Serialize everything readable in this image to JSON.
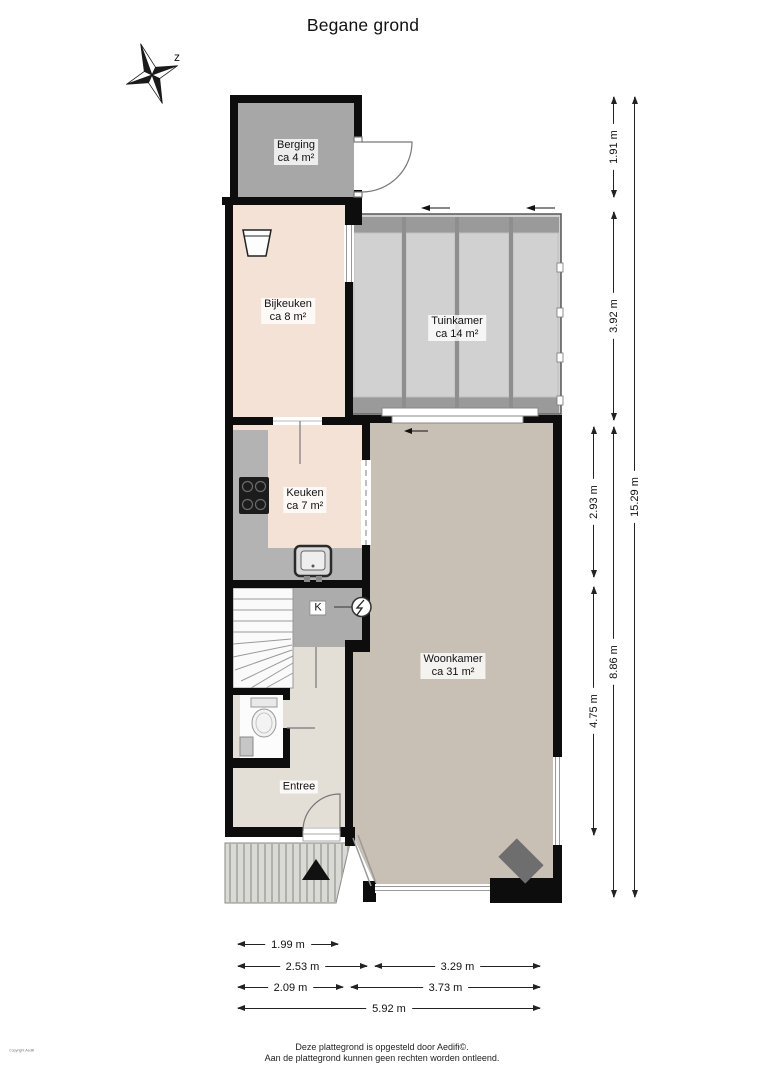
{
  "title": "Begane grond",
  "compass": {
    "label": "z"
  },
  "rooms": {
    "berging": {
      "name": "Berging",
      "area": "ca 4 m²"
    },
    "bijkeuken": {
      "name": "Bijkeuken",
      "area": "ca 8 m²"
    },
    "tuinkamer": {
      "name": "Tuinkamer",
      "area": "ca 14 m²"
    },
    "keuken": {
      "name": "Keuken",
      "area": "ca 7 m²"
    },
    "woonkamer": {
      "name": "Woonkamer",
      "area": "ca 31 m²"
    },
    "entree": {
      "name": "Entree"
    },
    "kast": {
      "name": "K"
    }
  },
  "dimensions": {
    "right": [
      "1.91 m",
      "3.92 m",
      "2.93 m",
      "4.75 m",
      "8.86 m",
      "15.29 m"
    ],
    "bottom": [
      "1.99 m",
      "2.53 m",
      "3.29 m",
      "2.09 m",
      "3.73 m",
      "5.92 m"
    ]
  },
  "footer": {
    "line1": "Deze plattegrond is opgesteld door Aedifi©.",
    "line2": "Aan de plattegrond kunnen geen rechten worden ontleend."
  },
  "copyright_vertical": "Copyright Aedifi",
  "colors": {
    "wall": "#0d0d0d",
    "berging_floor": "#a7a7a7",
    "utility_floor": "#f5e2d6",
    "tuinkamer_floor": "#d1d1d1",
    "tuinkamer_band": "#9a9a9a",
    "woonkamer_floor": "#c9c0b5",
    "entree_floor": "#e3ded6",
    "counter": "#b3b3b3",
    "closet": "#acacac",
    "porch": "#d9d9d5",
    "porch_stripe": "#b0b0ab",
    "fireplace": "#6e6e6e",
    "dim_line": "#222222"
  }
}
